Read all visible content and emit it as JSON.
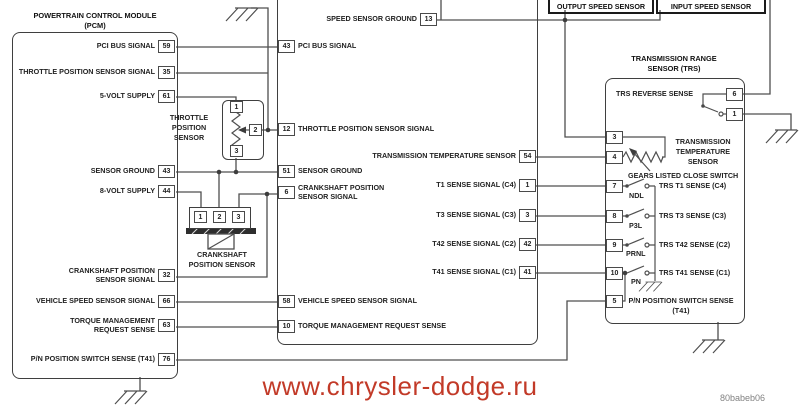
{
  "watermark": "www.chrysler-dodge.ru",
  "figure_code": "80babeb06",
  "colors": {
    "watermark_red": "#c23a28",
    "wire_gray": "#4f4f4f"
  },
  "pcm": {
    "title_line1": "POWERTRAIN CONTROL MODULE",
    "title_line2": "(PCM)",
    "pins": [
      {
        "label": "PCI BUS SIGNAL",
        "num": "59"
      },
      {
        "label": "THROTTLE POSITION SENSOR SIGNAL",
        "num": "35"
      },
      {
        "label": "5-VOLT SUPPLY",
        "num": "61"
      },
      {
        "label": "SENSOR GROUND",
        "num": "43"
      },
      {
        "label": "8-VOLT SUPPLY",
        "num": "44"
      },
      {
        "label": "CRANKSHAFT POSITION SENSOR SIGNAL",
        "num": "32"
      },
      {
        "label": "VEHICLE SPEED SENSOR SIGNAL",
        "num": "66"
      },
      {
        "label": "TORQUE MANAGEMENT REQUEST SENSE",
        "num": "63"
      },
      {
        "label": "P/N POSITION SWITCH SENSE (T41)",
        "num": "76"
      }
    ]
  },
  "tcm": {
    "pin_top": {
      "label": "SPEED SENSOR GROUND",
      "num": "13"
    },
    "pins_left": [
      {
        "num": "43",
        "label": "PCI BUS SIGNAL"
      },
      {
        "num": "12",
        "label": "THROTTLE POSITION SENSOR SIGNAL"
      },
      {
        "num": "51",
        "label": "SENSOR GROUND"
      },
      {
        "num": "6",
        "label": "CRANKSHAFT POSITION SENSOR SIGNAL"
      },
      {
        "num": "58",
        "label": "VEHICLE SPEED SENSOR SIGNAL"
      },
      {
        "num": "10",
        "label": "TORQUE MANAGEMENT REQUEST SENSE"
      }
    ],
    "pins_right": [
      {
        "label": "TRANSMISSION TEMPERATURE SENSOR",
        "num": "54"
      },
      {
        "label": "T1 SENSE SIGNAL (C4)",
        "num": "1"
      },
      {
        "label": "T3 SENSE SIGNAL (C3)",
        "num": "3"
      },
      {
        "label": "T42 SENSE SIGNAL (C2)",
        "num": "42"
      },
      {
        "label": "T41 SENSE SIGNAL (C1)",
        "num": "41"
      }
    ]
  },
  "speed_sensors": {
    "output_label": "OUTPUT SPEED SENSOR",
    "input_label": "INPUT SPEED SENSOR"
  },
  "tps": {
    "label_lines": [
      "THROTTLE",
      "POSITION",
      "SENSOR"
    ],
    "pins": [
      "1",
      "2",
      "3"
    ]
  },
  "ckp": {
    "label_line1": "CRANKSHAFT",
    "label_line2": "POSITION SENSOR",
    "pins": [
      "1",
      "2",
      "3"
    ]
  },
  "trs": {
    "title_line1": "TRANSMISSION RANGE",
    "title_line2": "SENSOR (TRS)",
    "reverse_sense_label": "TRS REVERSE SENSE",
    "pin6": "6",
    "pin1": "1",
    "pin3": "3",
    "pin4": "4",
    "pin7": "7",
    "pin8": "8",
    "pin9": "9",
    "pin10": "10",
    "pin5": "5",
    "temp_label_lines": [
      "TRANSMISSION",
      "TEMPERATURE",
      "SENSOR"
    ],
    "gears_label": "GEARS LISTED CLOSE SWITCH",
    "switches": [
      {
        "name": "NDL",
        "sense": "TRS T1 SENSE (C4)"
      },
      {
        "name": "P3L",
        "sense": "TRS T3 SENSE (C3)"
      },
      {
        "name": "PRNL",
        "sense": "TRS T42 SENSE (C2)"
      },
      {
        "name": "PN",
        "sense": "TRS T41 SENSE (C1)"
      }
    ],
    "pn_label_line1": "P/N POSITION SWITCH SENSE",
    "pn_label_line2": "(T41)"
  }
}
